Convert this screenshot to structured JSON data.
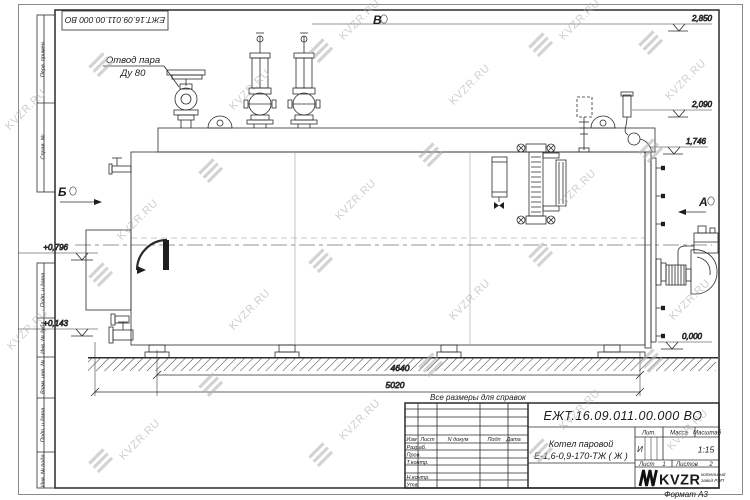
{
  "watermark": {
    "text": "KVZR.RU"
  },
  "frame_stamps": {
    "top_doc_number": "ЕЖТ.16.09.011.00.000  ВО",
    "perv_primen": "Перв. примен.",
    "sprav_no": "Справ. №",
    "podp_data_1": "Подп. и дата",
    "inv_dubl": "Инв. № дубл.",
    "vzam_inv": "Взам. инв. №",
    "podp_data_2": "Подп. и дата",
    "inv_podl": "Инв. № подл."
  },
  "drawing": {
    "callout": {
      "line1": "Отвод пара",
      "line2": "Ду 80"
    },
    "views": {
      "b": "Б",
      "v": "В",
      "a": "А"
    },
    "levels": {
      "top": "2,850",
      "mid": "2,090",
      "band": "1,746",
      "burner": "+0,796",
      "low": "+0,143",
      "ground": "0,000"
    },
    "dimensions": {
      "inner": "4640",
      "overall": "5020"
    },
    "note": "Все размеры для справок"
  },
  "titleblock": {
    "doc_number": "ЕЖТ.16.09.011.00.000  ВО",
    "product_name_line1": "Котел паровой",
    "product_name_line2": "Е-1,6-0,9-170-ТЖ ( Ж )",
    "columns": {
      "izm": "Изм",
      "list": "Лист",
      "n_dokum": "N докум",
      "podp": "Подп",
      "data": "Дата"
    },
    "rows": {
      "razrab": "Разраб.",
      "prov": "Пров.",
      "t_kontr": "Т.контр.",
      "n_kontr": "Н.контр.",
      "utv": "Утв."
    },
    "lit_label": "Лит.",
    "mass_label": "Масса",
    "scale_label": "Масштаб",
    "lit_value": "И",
    "scale_value": "1:15",
    "sheet_label": "Лист",
    "sheet_value": "1",
    "sheets_label": "Листов",
    "sheets_value": "2",
    "logo": {
      "name": "KVZR",
      "caption_line1": "котельный",
      "caption_line2": "завод РЭП"
    },
    "format_label": "Формат А3"
  }
}
